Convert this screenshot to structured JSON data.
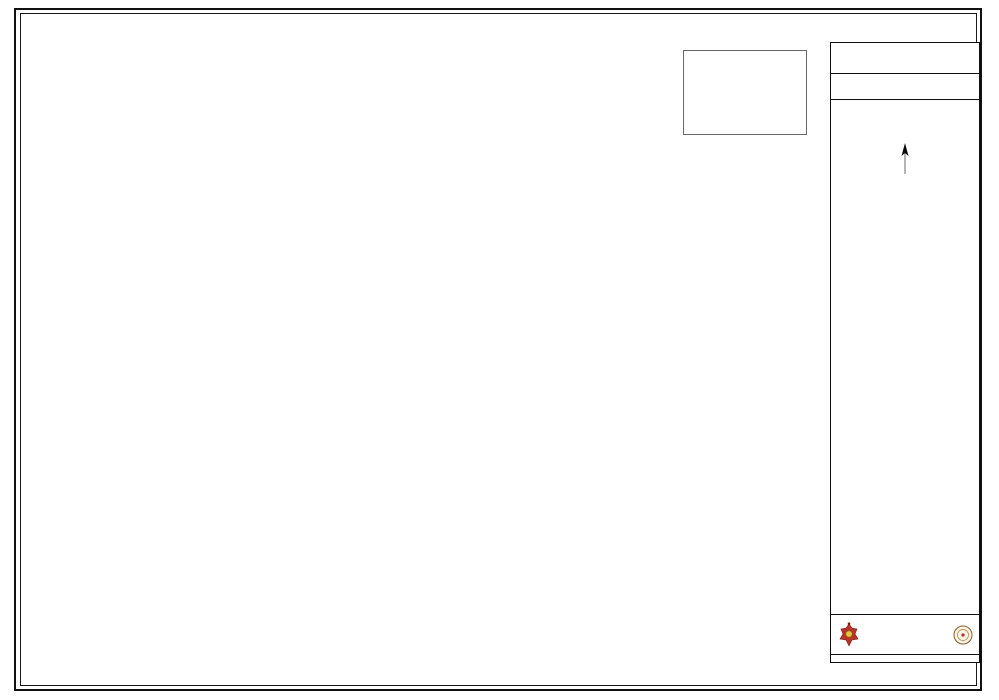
{
  "panel": {
    "title": "Kathmandu Metropolitan City",
    "ward_no": "Ward No. 17",
    "profile_title": "Ward Profile",
    "north_label": "N",
    "scale": {
      "left": "75",
      "zero": "0",
      "right": "75",
      "unit": "Meters"
    }
  },
  "inset": {
    "title": "Kathmandu Metropolitan City"
  },
  "legend": {
    "title": "Legend",
    "subtitle": "Services",
    "services": [
      {
        "icon": "dhungedhara-icon",
        "label": "Dhungedhara"
      },
      {
        "icon": "hospital-icon",
        "label": "Hospital/Health Post"
      },
      {
        "icon": "temple-icon",
        "label": "Temple"
      },
      {
        "icon": "recreational-park-icon",
        "label": "Recreational Park"
      },
      {
        "icon": "well-icon",
        "label": "Well"
      },
      {
        "icon": "cemetery-icon",
        "label": "Cemetry"
      },
      {
        "icon": "water-tank-icon",
        "label": "Water Tank"
      },
      {
        "icon": "public-tap-icon",
        "label": "Public Tap"
      },
      {
        "icon": "ward-office-icon",
        "label": "Ward Office"
      },
      {
        "icon": "public-institution-icon",
        "label": "Public Institution"
      },
      {
        "icon": "public-services-icon",
        "label": "Public Services"
      },
      {
        "icon": "school-icon",
        "label": "School/University"
      },
      {
        "icon": "bridge-icon",
        "label": "Bridge"
      }
    ],
    "line_items": [
      {
        "icon": "passage-icon",
        "label": "Passage under building"
      },
      {
        "icon": "ward-boundary-icon",
        "label": "Ward Boundary"
      }
    ],
    "area_items": [
      {
        "label": "Pitch Road",
        "color": "#bdbab2"
      },
      {
        "label": "Gravel Road",
        "color": "#a6745a"
      },
      {
        "label": "Pave Trail",
        "color": "#8f9c52"
      },
      {
        "label": "Brick Pavement",
        "color": "#7c680e"
      },
      {
        "label": "Stone Pavement",
        "color": "#46094d"
      },
      {
        "label": "Water Bodies /Pond",
        "color": "#1c86ee"
      },
      {
        "label": "Sandy Area",
        "color": "#f0efe9"
      },
      {
        "label": "Building footprint",
        "color": "#f6a70b"
      }
    ]
  },
  "map": {
    "colors": {
      "building": "#f6a70b",
      "building_stroke": "#bd7e00",
      "water": "#2176d2",
      "sandy": "#efeee7",
      "gravel": "#a6745a",
      "pitch_casing": "#99968e",
      "pitch_fill": "#d8d6cf",
      "pave_trail": "#7f8f45",
      "brick": "#7c680e",
      "stone": "#46094d",
      "grid": "#cfcfca",
      "boundary": "#000000"
    },
    "ward_labels": [
      {
        "text": "Ward No. 16",
        "x": 238,
        "y": 66
      },
      {
        "text": "Ward No. 15",
        "x": 110,
        "y": 300
      },
      {
        "text": "Ward No. 18",
        "x": 346,
        "y": 566
      },
      {
        "text": "Ward No. 28",
        "x": 506,
        "y": 635
      },
      {
        "text": "Ward No. 29",
        "x": 632,
        "y": 456
      }
    ],
    "place_labels": [
      {
        "text": "Khushiboo",
        "x": 242,
        "y": 228,
        "size": 11
      },
      {
        "text": "Kusale",
        "x": 371,
        "y": 327,
        "size": 10
      },
      {
        "text": "Chaur",
        "x": 369,
        "y": 341,
        "size": 10
      },
      {
        "text": "Dhobichaur",
        "x": 414,
        "y": 434,
        "size": 11.5
      },
      {
        "text": "Chhetrapati",
        "x": 531,
        "y": 542,
        "size": 11.5
      },
      {
        "text": "Thahiti",
        "x": 649,
        "y": 600,
        "size": 11.5
      },
      {
        "text": "Kwabahal",
        "x": 599,
        "y": 514,
        "size": 6.5
      }
    ],
    "poi_labels": [
      {
        "text": "Cemetery of",
        "x": 392,
        "y": 272
      },
      {
        "text": "Kusali Society",
        "x": 393,
        "y": 280
      },
      {
        "text": "Baktakan",
        "x": 264,
        "y": 303
      },
      {
        "text": "School",
        "x": 262,
        "y": 311
      },
      {
        "text": "Shova Bhagwati",
        "x": 268,
        "y": 418
      },
      {
        "text": "School",
        "x": 266,
        "y": 426
      },
      {
        "text": "Academy Higher",
        "x": 305,
        "y": 385
      },
      {
        "text": "School",
        "x": 303,
        "y": 393
      },
      {
        "text": "Public Yuth",
        "x": 470,
        "y": 458
      },
      {
        "text": "Campus",
        "x": 468,
        "y": 466
      },
      {
        "text": "Saraswati",
        "x": 522,
        "y": 465
      },
      {
        "text": "School",
        "x": 521,
        "y": 473
      },
      {
        "text": "Kathmandu Model",
        "x": 449,
        "y": 553
      },
      {
        "text": "College",
        "x": 447,
        "y": 561
      },
      {
        "text": "Shanti Sudha",
        "x": 566,
        "y": 531
      },
      {
        "text": "Mandir",
        "x": 563,
        "y": 539
      },
      {
        "text": "Post Clinic",
        "x": 549,
        "y": 570
      },
      {
        "text": "Ward Office",
        "x": 590,
        "y": 592,
        "color": "#8a2020"
      }
    ],
    "river_label": {
      "text": "Bagmati River",
      "x": 186,
      "y": 386,
      "rotate": -72
    },
    "grid_x": [
      {
        "x": 142,
        "label": "329500"
      },
      {
        "x": 306,
        "label": "329750"
      },
      {
        "x": 470,
        "label": "330000"
      },
      {
        "x": 634,
        "label": "330250"
      },
      {
        "x": 798,
        "label": "330500"
      }
    ],
    "grid_y": [
      {
        "y": 130,
        "label": "99500"
      },
      {
        "y": 287,
        "label": "99250"
      },
      {
        "y": 444,
        "label": "99000"
      },
      {
        "y": 601,
        "label": "98750"
      }
    ],
    "markers": {
      "recreational_park": [
        [
          347,
          297
        ],
        [
          437,
          417
        ],
        [
          446,
          462
        ]
      ],
      "hospital": [
        [
          524,
          568
        ]
      ],
      "well": [
        [
          616,
          562
        ],
        [
          628,
          563
        ],
        [
          641,
          559
        ],
        [
          617,
          588
        ],
        [
          622,
          596
        ],
        [
          606,
          600
        ],
        [
          634,
          601
        ],
        [
          592,
          567
        ],
        [
          652,
          546
        ],
        [
          530,
          460
        ],
        [
          495,
          490
        ],
        [
          392,
          489
        ],
        [
          370,
          462
        ],
        [
          590,
          609
        ]
      ],
      "temple": [
        [
          560,
          521
        ],
        [
          600,
          585
        ],
        [
          646,
          521
        ],
        [
          251,
          367
        ],
        [
          310,
          525
        ]
      ],
      "ward_office": [
        [
          577,
          578
        ],
        [
          633,
          584
        ]
      ],
      "public_institution": [
        [
          545,
          557
        ],
        [
          627,
          545
        ]
      ],
      "public_services": [
        [
          505,
          559
        ],
        [
          413,
          519
        ],
        [
          468,
          590
        ]
      ],
      "school": [
        [
          247,
          294
        ],
        [
          433,
          448
        ],
        [
          463,
          546
        ],
        [
          514,
          463
        ]
      ],
      "water_tank": [
        [
          383,
          284
        ]
      ],
      "public_tap": [
        [
          353,
          287
        ]
      ],
      "cemetery": [
        [
          391,
          290
        ]
      ]
    }
  },
  "source_note": {
    "lines": [
      "Source:",
      "Based Map on KUDP (Kathmandu",
      "Urban Development Project,1998) &",
      "KMC/KVMP, IAP Survey."
    ]
  },
  "credits": {
    "org": "Kathmandu Metropolitan City",
    "dept": "Urban Development Department",
    "date_label": "Date:",
    "date": "August 2011"
  }
}
